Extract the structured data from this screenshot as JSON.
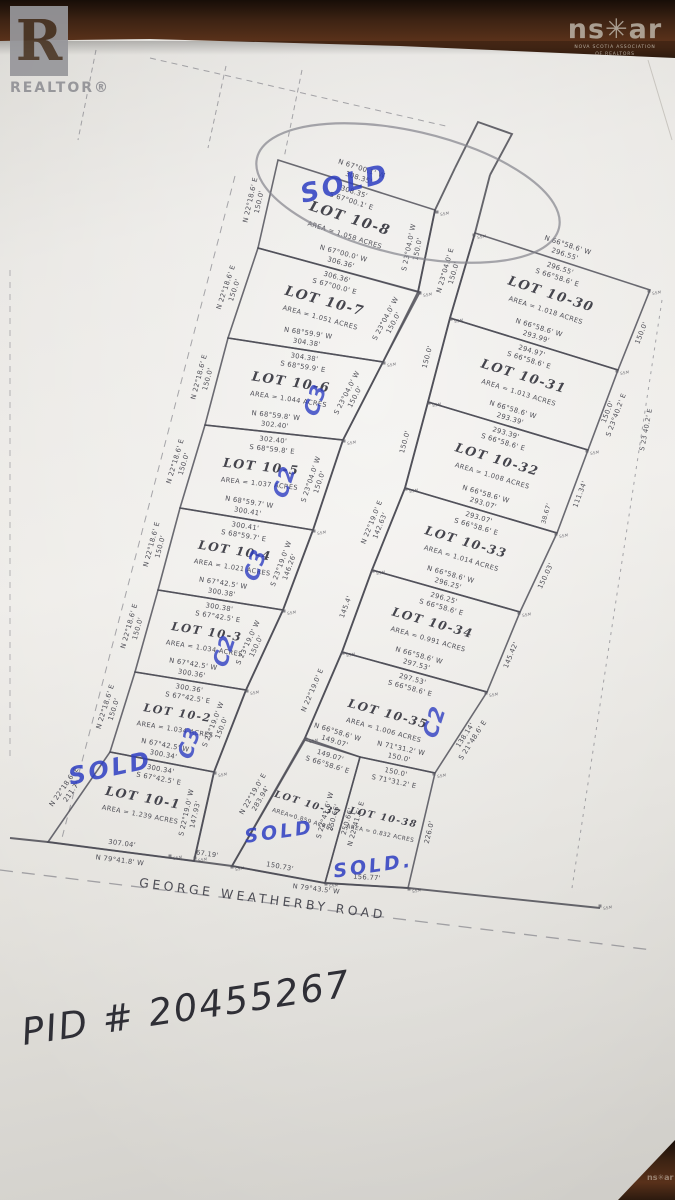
{
  "photo": {
    "realtor_logo": "R",
    "realtor_word": "REALTOR®",
    "nsar_logo": "ns✳ar",
    "nsar_sub1": "NOVA SCOTIA ASSOCIATION",
    "nsar_sub2": "OF REALTORS",
    "pid_label": "PID # 20455267"
  },
  "plan": {
    "ink": "#41414a",
    "line_color": "#4c4c55",
    "blue": "#2e3ec2",
    "marker_label": "SSM",
    "road_name": "GEORGE WEATHERBY ROAD",
    "lots": [
      {
        "id": "10-8",
        "label": "LOT 10-8",
        "area": "AREA = 1.058 ACRES",
        "ns": 14,
        "poly": [
          [
            278,
            160
          ],
          [
            435,
            210
          ],
          [
            418,
            292
          ],
          [
            258,
            248
          ]
        ],
        "top": {
          "ob": "N 67°00.1' W",
          "od": "308.35'",
          "idd": "308.35'",
          "ib": "S 67°00.1' E"
        },
        "left": [
          "N 22°18.6' E",
          "150.0'"
        ],
        "right": [
          "S 23°04.0' W",
          "150.0'"
        ],
        "right_side": "in",
        "sold": {
          "x": 347,
          "y": 192,
          "r": -14,
          "s": 26
        }
      },
      {
        "id": "10-7",
        "label": "LOT 10-7",
        "area": "AREA = 1.051 ACRES",
        "ns": 13.5,
        "poly": [
          [
            258,
            248
          ],
          [
            420,
            292
          ],
          [
            383,
            362
          ],
          [
            228,
            338
          ]
        ],
        "top": {
          "ob": "N 67°00.0' W",
          "od": "306.36'",
          "idd": "306.36'",
          "ib": "S 67°00.0' E"
        },
        "left": [
          "N 22°18.6' E",
          "150.0'"
        ],
        "right": [
          "S 23°04.0' W",
          "150.0'"
        ],
        "right_side": "in"
      },
      {
        "id": "10-6",
        "label": "LOT 10-6",
        "area": "AREA = 1.044 ACRES",
        "ns": 13,
        "poly": [
          [
            228,
            338
          ],
          [
            383,
            362
          ],
          [
            343,
            440
          ],
          [
            205,
            425
          ]
        ],
        "top": {
          "ob": "N 68°59.9' W",
          "od": "304.38'",
          "idd": "304.38'",
          "ib": "S 68°59.9' E"
        },
        "left": [
          "N 22°18.6' E",
          "150.0'"
        ],
        "right": [
          "S 23°04.0' W",
          "150.0'"
        ],
        "right_side": "in",
        "mark": {
          "t": "C3",
          "x": 322,
          "y": 402,
          "r": -72
        }
      },
      {
        "id": "10-5",
        "label": "LOT 10-5",
        "area": "AREA = 1.037 ACRES",
        "ns": 12.5,
        "poly": [
          [
            205,
            425
          ],
          [
            343,
            440
          ],
          [
            313,
            530
          ],
          [
            180,
            508
          ]
        ],
        "top": {
          "ob": "N 68°59.8' W",
          "od": "302.40'",
          "idd": "302.40'",
          "ib": "S 68°59.8' E"
        },
        "left": [
          "N 22°18.6' E",
          "150.0'"
        ],
        "right": [
          "S 23°04.0' W",
          "150.0'"
        ],
        "right_side": "in",
        "mark": {
          "t": "C2",
          "x": 291,
          "y": 484,
          "r": -72
        }
      },
      {
        "id": "10-4",
        "label": "LOT 10-4",
        "area": "AREA = 1.021 ACRES",
        "ns": 12,
        "poly": [
          [
            180,
            508
          ],
          [
            313,
            530
          ],
          [
            283,
            610
          ],
          [
            158,
            590
          ]
        ],
        "top": {
          "ob": "N 68°59.7' W",
          "od": "300.41'",
          "idd": "300.41'",
          "ib": "S 68°59.7' E"
        },
        "left": [
          "N 22°18.6' E",
          "150.0'"
        ],
        "right": [
          "S 23°19.0' W",
          "146.26'"
        ],
        "right_side": "in",
        "mark": {
          "t": "C3",
          "x": 262,
          "y": 567,
          "r": -72
        }
      },
      {
        "id": "10-3",
        "label": "LOT 10-3",
        "area": "AREA = 1.034 ACRES",
        "ns": 11.5,
        "poly": [
          [
            158,
            590
          ],
          [
            283,
            610
          ],
          [
            246,
            690
          ],
          [
            135,
            672
          ]
        ],
        "top": {
          "ob": "N 67°42.5' W",
          "od": "300.38'",
          "idd": "300.38'",
          "ib": "S 67°42.5' E"
        },
        "left": [
          "N 22°18.6' E",
          "150.0'"
        ],
        "right": [
          "S 23°19.0' W",
          "150.0'"
        ],
        "right_side": "in",
        "mark": {
          "t": "C2",
          "x": 231,
          "y": 653,
          "r": -72
        }
      },
      {
        "id": "10-2",
        "label": "LOT 10-2",
        "area": "AREA = 1.034 ACRES",
        "ns": 11,
        "poly": [
          [
            135,
            672
          ],
          [
            246,
            690
          ],
          [
            214,
            772
          ],
          [
            110,
            752
          ]
        ],
        "top": {
          "ob": "N 67°42.5' W",
          "od": "300.36'",
          "idd": "300.36'",
          "ib": "S 67°42.5' E"
        },
        "left": [
          "N 22°18.6' E",
          "150.0'"
        ],
        "right": [
          "S 23°19.0' W",
          "150.0'"
        ],
        "right_side": "in",
        "mark": {
          "t": "C3",
          "x": 196,
          "y": 745,
          "r": -72
        }
      },
      {
        "id": "10-1",
        "label": "LOT 10-1",
        "area": "AREA = 1.239 ACRES",
        "ns": 12.5,
        "poly": [
          [
            110,
            752
          ],
          [
            214,
            772
          ],
          [
            194,
            861
          ],
          [
            48,
            842
          ]
        ],
        "top": {
          "ob": "N 67°42.5' W",
          "od": "300.34'",
          "idd": "300.34'",
          "ib": "S 67°42.5' E"
        },
        "left": [
          "N 22°18.6' E",
          "211.7'"
        ],
        "right": [
          "S 22°19.0' W",
          "147.93'"
        ],
        "right_side": "in",
        "bottom": {
          "od": "307.04'",
          "ib": "N 79°41.8' W"
        },
        "sold": {
          "x": 112,
          "y": 776,
          "r": -12,
          "s": 24
        }
      },
      {
        "id": "10-30",
        "label": "LOT 10-30",
        "area": "AREA = 1.018 ACRES",
        "ns": 13,
        "poly": [
          [
            475,
            233
          ],
          [
            650,
            290
          ],
          [
            618,
            370
          ],
          [
            450,
            318
          ]
        ],
        "top": {
          "ob": "N 66°58.6' W",
          "od": "296.55'",
          "idd": "296.55'",
          "ib": "S 66°58.6' E"
        },
        "left": [
          "N 23°04.0' E",
          "150.0'"
        ],
        "right": [
          "150.0'"
        ]
      },
      {
        "id": "10-31",
        "label": "LOT 10-31",
        "area": "AREA = 1.013 ACRES",
        "ns": 12.8,
        "poly": [
          [
            450,
            318
          ],
          [
            618,
            370
          ],
          [
            588,
            450
          ],
          [
            428,
            402
          ]
        ],
        "top": {
          "ob": "N 66°58.6' W",
          "od": "293.99'",
          "idd": "294.97'",
          "ib": "S 66°58.6' E"
        },
        "left": [
          "150.0'"
        ],
        "right": [
          "S 23°40.2' E",
          "150.0'"
        ]
      },
      {
        "id": "10-32",
        "label": "LOT 10-32",
        "area": "AREA = 1.008 ACRES",
        "ns": 12.5,
        "poly": [
          [
            428,
            402
          ],
          [
            588,
            450
          ],
          [
            557,
            533
          ],
          [
            405,
            488
          ]
        ],
        "top": {
          "ob": "N 66°58.6' W",
          "od": "293.39'",
          "idd": "293.39'",
          "ib": "S 66°58.6' E"
        },
        "left": [
          "150.0'"
        ],
        "right": [
          "111.34'"
        ]
      },
      {
        "id": "10-33",
        "label": "LOT 10-33",
        "area": "AREA = 1.014 ACRES",
        "ns": 12.2,
        "poly": [
          [
            405,
            488
          ],
          [
            557,
            533
          ],
          [
            520,
            612
          ],
          [
            372,
            570
          ]
        ],
        "top": {
          "ob": "N 66°58.6' W",
          "od": "293.07'",
          "idd": "293.07'",
          "ib": "S 66°58.6' E"
        },
        "left": [
          "N 22°19.0' E",
          "142.63'"
        ],
        "right": [
          "150.03'"
        ]
      },
      {
        "id": "10-34",
        "label": "LOT 10-34",
        "area": "AREA = 0.991 ACRES",
        "ns": 12,
        "poly": [
          [
            372,
            570
          ],
          [
            520,
            612
          ],
          [
            487,
            692
          ],
          [
            342,
            652
          ]
        ],
        "top": {
          "ob": "N 66°58.6' W",
          "od": "296.25'",
          "idd": "296.25'",
          "ib": "S 66°58.6' E"
        },
        "left": [
          "145.4'"
        ],
        "right": [
          "145.42'"
        ]
      },
      {
        "id": "10-35",
        "label": "LOT 10-35",
        "area": "AREA = 1.006 ACRES",
        "ns": 11.8,
        "poly": [
          [
            342,
            652
          ],
          [
            487,
            692
          ],
          [
            435,
            773
          ],
          [
            360,
            757
          ],
          [
            305,
            738
          ]
        ],
        "top": {
          "ob": "N 66°58.6' W",
          "od": "297.53'",
          "idd": "297.53'",
          "ib": "S 66°58.6' E"
        },
        "left": [
          "N 22°19.0' E"
        ],
        "right": [
          "S 21°48.6' E",
          "138.14'"
        ],
        "mark": {
          "t": "C2",
          "x": 441,
          "y": 724,
          "r": -72
        }
      },
      {
        "id": "10-37",
        "label": "LOT 10-37",
        "area": "AREA=0.859 ACRES",
        "ns": 9.5,
        "as": 5.8,
        "poly": [
          [
            305,
            740
          ],
          [
            360,
            757
          ],
          [
            325,
            883
          ],
          [
            232,
            866
          ]
        ],
        "top": {
          "ob": "N 66°58.6' W",
          "od": "149.07'",
          "idd": "149.07'",
          "ib": "S 66°58.6' E"
        },
        "left": [
          "N 22°19.0' E",
          "283.94'"
        ],
        "right": [
          "S 22°41.6' W",
          "250.66'"
        ],
        "right_side": "in",
        "bottom": {
          "od": "150.73'"
        },
        "sold": {
          "x": 280,
          "y": 838,
          "r": -8,
          "s": 19
        }
      },
      {
        "id": "10-38",
        "label": "LOT 10-38",
        "area": "AREA = 0.832 ACRES",
        "ns": 9.5,
        "as": 5.8,
        "poly": [
          [
            360,
            757
          ],
          [
            435,
            773
          ],
          [
            408,
            888
          ],
          [
            325,
            883
          ]
        ],
        "top": {
          "ob": "N 71°31.2' W",
          "od": "150.0'",
          "idd": "150.0'",
          "ib": "S 71°31.2' E"
        },
        "left": [
          "N 22°41.6' E",
          "250.66'"
        ],
        "left_side": "in",
        "right": [
          "226.0'"
        ],
        "bottom": {
          "od": "156.77'"
        },
        "sold": {
          "t": "SOLD.",
          "x": 374,
          "y": 872,
          "r": -8,
          "s": 19
        }
      }
    ],
    "road_west": [
      [
        455,
        168
      ],
      [
        435,
        210
      ],
      [
        418,
        292
      ],
      [
        383,
        362
      ],
      [
        343,
        440
      ],
      [
        313,
        530
      ],
      [
        283,
        610
      ],
      [
        246,
        690
      ],
      [
        214,
        772
      ],
      [
        194,
        861
      ]
    ],
    "road_east": [
      [
        490,
        175
      ],
      [
        475,
        233
      ],
      [
        450,
        318
      ],
      [
        428,
        402
      ],
      [
        405,
        488
      ],
      [
        372,
        570
      ],
      [
        342,
        652
      ],
      [
        305,
        738
      ],
      [
        232,
        866
      ]
    ],
    "stub": [
      [
        455,
        168
      ],
      [
        478,
        122
      ],
      [
        512,
        134
      ],
      [
        490,
        175
      ]
    ],
    "bottom_road": [
      [
        10,
        838
      ],
      [
        48,
        842
      ],
      [
        194,
        861
      ],
      [
        232,
        866
      ],
      [
        325,
        883
      ],
      [
        408,
        888
      ],
      [
        600,
        908
      ]
    ],
    "dashed": [
      {
        "pts": [
          [
            0,
            870
          ],
          [
            652,
            950
          ]
        ],
        "dash": "13 9",
        "w": 1.3
      },
      {
        "pts": [
          [
            150,
            58
          ],
          [
            450,
            127
          ]
        ],
        "dash": "6 5",
        "w": 1
      },
      {
        "pts": [
          [
            302,
            70
          ],
          [
            284,
            158
          ]
        ],
        "dash": "5 4",
        "w": 1
      },
      {
        "pts": [
          [
            226,
            66
          ],
          [
            208,
            148
          ]
        ],
        "dash": "5 4",
        "w": 1
      },
      {
        "pts": [
          [
            96,
            50
          ],
          [
            78,
            140
          ]
        ],
        "dash": "5 4",
        "w": 1
      },
      {
        "pts": [
          [
            235,
            176
          ],
          [
            62,
            838
          ]
        ],
        "dash": "7 6",
        "w": 1
      },
      {
        "pts": [
          [
            662,
            300
          ],
          [
            572,
            888
          ]
        ],
        "dash": "3 5",
        "w": 1
      },
      {
        "pts": [
          [
            10,
            270
          ],
          [
            10,
            760
          ]
        ],
        "dash": "6 6",
        "w": 0.8
      }
    ],
    "ellipse": {
      "cx": 408,
      "cy": 193,
      "rx": 155,
      "ry": 62,
      "rot": 13
    },
    "extra": [
      {
        "t": "GEORGE WEATHERBY ROAD",
        "x": 262,
        "y": 903,
        "r": 7.5,
        "s": 12.5,
        "ls": 3.5
      },
      {
        "t": "67.19'",
        "x": 207,
        "y": 856,
        "r": 8,
        "s": 6.6
      },
      {
        "t": "N 79°43.5' W",
        "x": 316,
        "y": 891,
        "r": 7,
        "s": 6.6
      },
      {
        "t": "S 23 40.2' E",
        "x": 648,
        "y": 430,
        "r": -79,
        "s": 6.6
      },
      {
        "t": "38.67'",
        "x": 548,
        "y": 514,
        "r": -74,
        "s": 6.2
      }
    ],
    "ssm": [
      [
        437,
        212
      ],
      [
        420,
        293
      ],
      [
        384,
        363
      ],
      [
        344,
        441
      ],
      [
        314,
        531
      ],
      [
        284,
        611
      ],
      [
        247,
        691
      ],
      [
        215,
        773
      ],
      [
        195,
        858
      ],
      [
        232,
        867
      ],
      [
        326,
        884
      ],
      [
        409,
        889
      ],
      [
        474,
        235
      ],
      [
        451,
        319
      ],
      [
        429,
        403
      ],
      [
        406,
        489
      ],
      [
        373,
        571
      ],
      [
        343,
        653
      ],
      [
        306,
        739
      ],
      [
        649,
        291
      ],
      [
        617,
        371
      ],
      [
        587,
        451
      ],
      [
        556,
        534
      ],
      [
        519,
        613
      ],
      [
        486,
        693
      ],
      [
        434,
        774
      ],
      [
        170,
        856
      ],
      [
        600,
        906
      ]
    ]
  }
}
